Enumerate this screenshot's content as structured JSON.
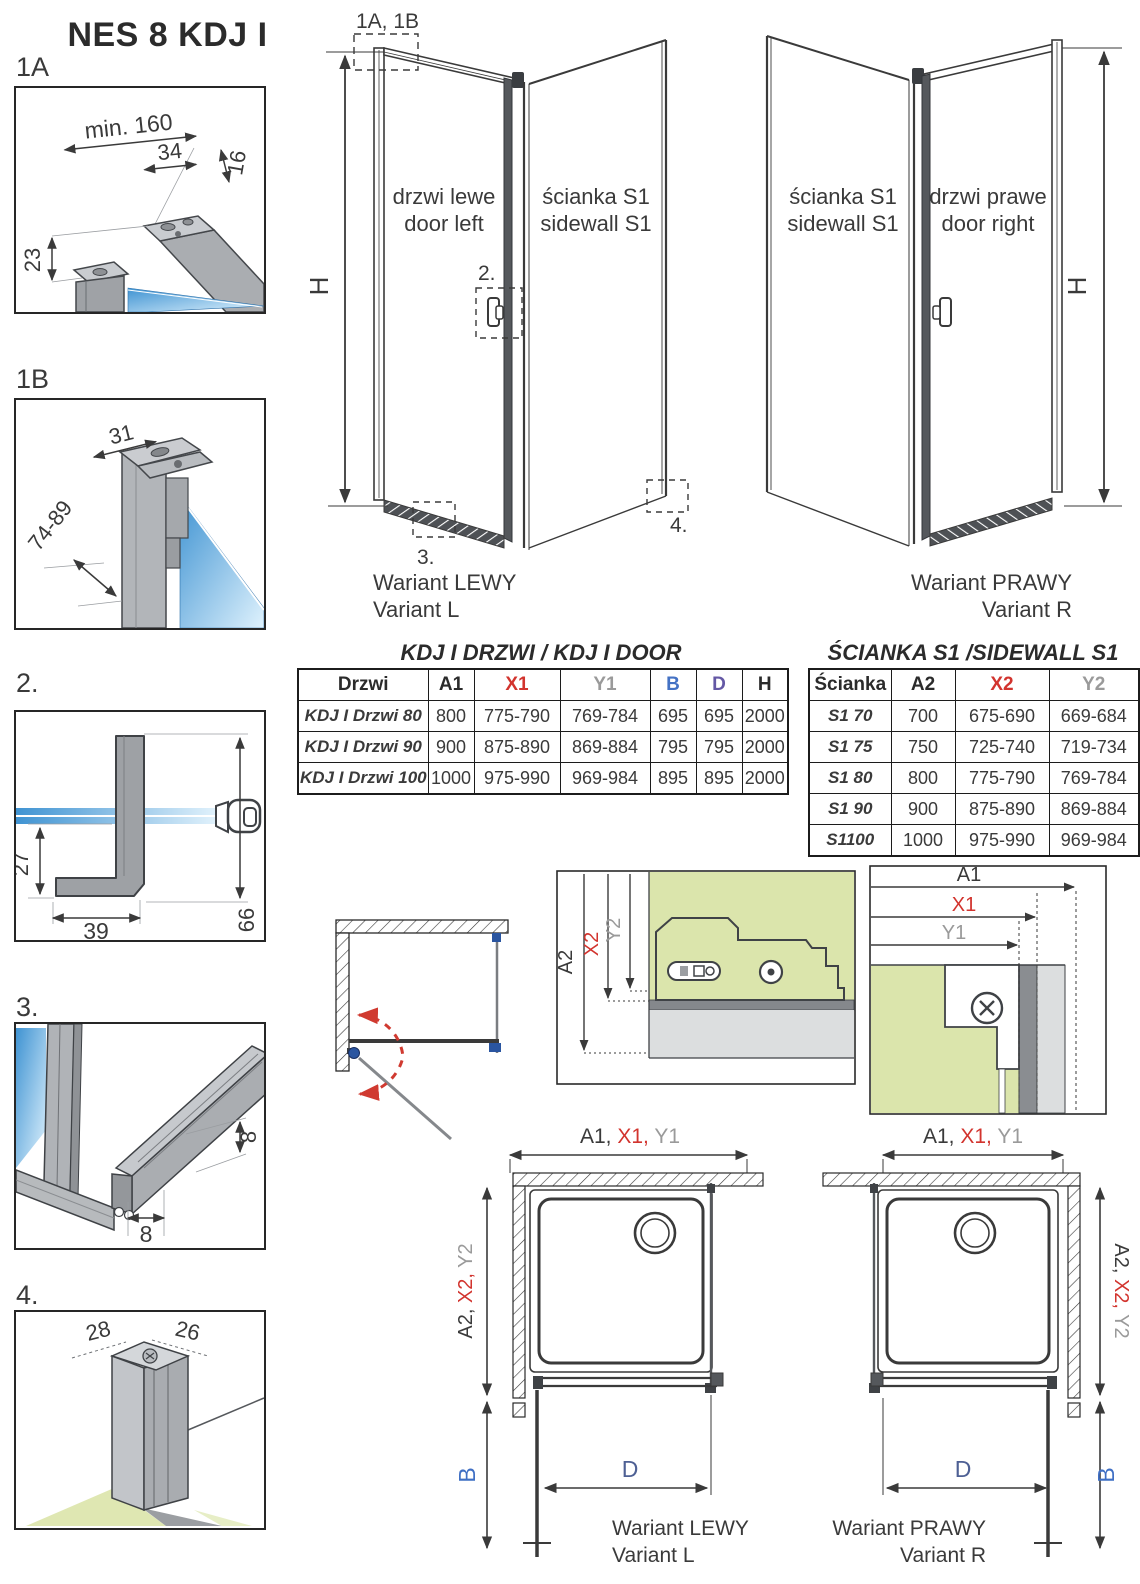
{
  "title": "NES 8 KDJ I",
  "colors": {
    "accent_red": "#d2342e",
    "accent_gray": "#9a9a9a",
    "accent_blue": "#4472c4",
    "accent_purple": "#6458a5",
    "glass_blue": "#3f93d2",
    "panel_green": "#dbe5ac",
    "hardware_blue": "#2a55a0"
  },
  "details": {
    "d1a": {
      "label": "1A",
      "dim_min": "min. 160",
      "dim_34": "34",
      "dim_16": "16",
      "dim_23": "23"
    },
    "d1b": {
      "label": "1B",
      "dim_31": "31",
      "dim_range": "74-89"
    },
    "d2": {
      "label": "2.",
      "dim_27": "27",
      "dim_39": "39",
      "dim_66": "66"
    },
    "d3": {
      "label": "3.",
      "dim_8v": "8",
      "dim_8h": "8"
    },
    "d4": {
      "label": "4.",
      "dim_28": "28",
      "dim_26": "26"
    }
  },
  "iso_left": {
    "ref": "1A, 1B",
    "h": "H",
    "door_line1": "drzwi lewe",
    "door_line2": "door left",
    "wall_line1": "ścianka S1",
    "wall_line2": "sidewall S1",
    "m2": "2.",
    "m3": "3.",
    "m4": "4.",
    "cap1": "Wariant LEWY",
    "cap2": "Variant L"
  },
  "iso_right": {
    "h": "H",
    "wall_line1": "ścianka S1",
    "wall_line2": "sidewall S1",
    "door_line1": "drzwi prawe",
    "door_line2": "door right",
    "cap1": "Wariant PRAWY",
    "cap2": "Variant R"
  },
  "door_table": {
    "title": "KDJ I DRZWI / KDJ I DOOR",
    "headers": [
      "Drzwi",
      "A1",
      "X1",
      "Y1",
      "B",
      "D",
      "H"
    ],
    "header_colors": [
      "#2b2b2b",
      "#2b2b2b",
      "#d2342e",
      "#9a9a9a",
      "#4472c4",
      "#6458a5",
      "#2b2b2b"
    ],
    "rows": [
      [
        "KDJ I Drzwi 80",
        "800",
        "775-790",
        "769-784",
        "695",
        "695",
        "2000"
      ],
      [
        "KDJ I Drzwi 90",
        "900",
        "875-890",
        "869-884",
        "795",
        "795",
        "2000"
      ],
      [
        "KDJ I Drzwi 100",
        "1000",
        "975-990",
        "969-984",
        "895",
        "895",
        "2000"
      ]
    ]
  },
  "sidewall_table": {
    "title": "ŚCIANKA S1 /SIDEWALL S1",
    "headers": [
      "Ścianka",
      "A2",
      "X2",
      "Y2"
    ],
    "header_colors": [
      "#2b2b2b",
      "#2b2b2b",
      "#d2342e",
      "#9a9a9a"
    ],
    "rows": [
      [
        "S1 70",
        "700",
        "675-690",
        "669-684"
      ],
      [
        "S1 75",
        "750",
        "725-740",
        "719-734"
      ],
      [
        "S1 80",
        "800",
        "775-790",
        "769-784"
      ],
      [
        "S1 90",
        "900",
        "875-890",
        "869-884"
      ],
      [
        "S1100",
        "1000",
        "975-990",
        "969-984"
      ]
    ]
  },
  "detail_a2": {
    "a2": "A2",
    "x2": "X2",
    "y2": "Y2"
  },
  "detail_a1": {
    "a1": "A1",
    "x1": "X1",
    "y1": "Y1"
  },
  "plan_left": {
    "top": [
      "A1, ",
      "X1, ",
      "Y1"
    ],
    "side": [
      "A2, ",
      "X2, ",
      "Y2"
    ],
    "b": "B",
    "d": "D",
    "cap1": "Wariant LEWY",
    "cap2": "Variant L"
  },
  "plan_right": {
    "top": [
      "A1, ",
      "X1, ",
      "Y1"
    ],
    "side": [
      "A2, ",
      "X2, ",
      "Y2"
    ],
    "b": "B",
    "d": "D",
    "cap1": "Wariant PRAWY",
    "cap2": "Variant R"
  }
}
